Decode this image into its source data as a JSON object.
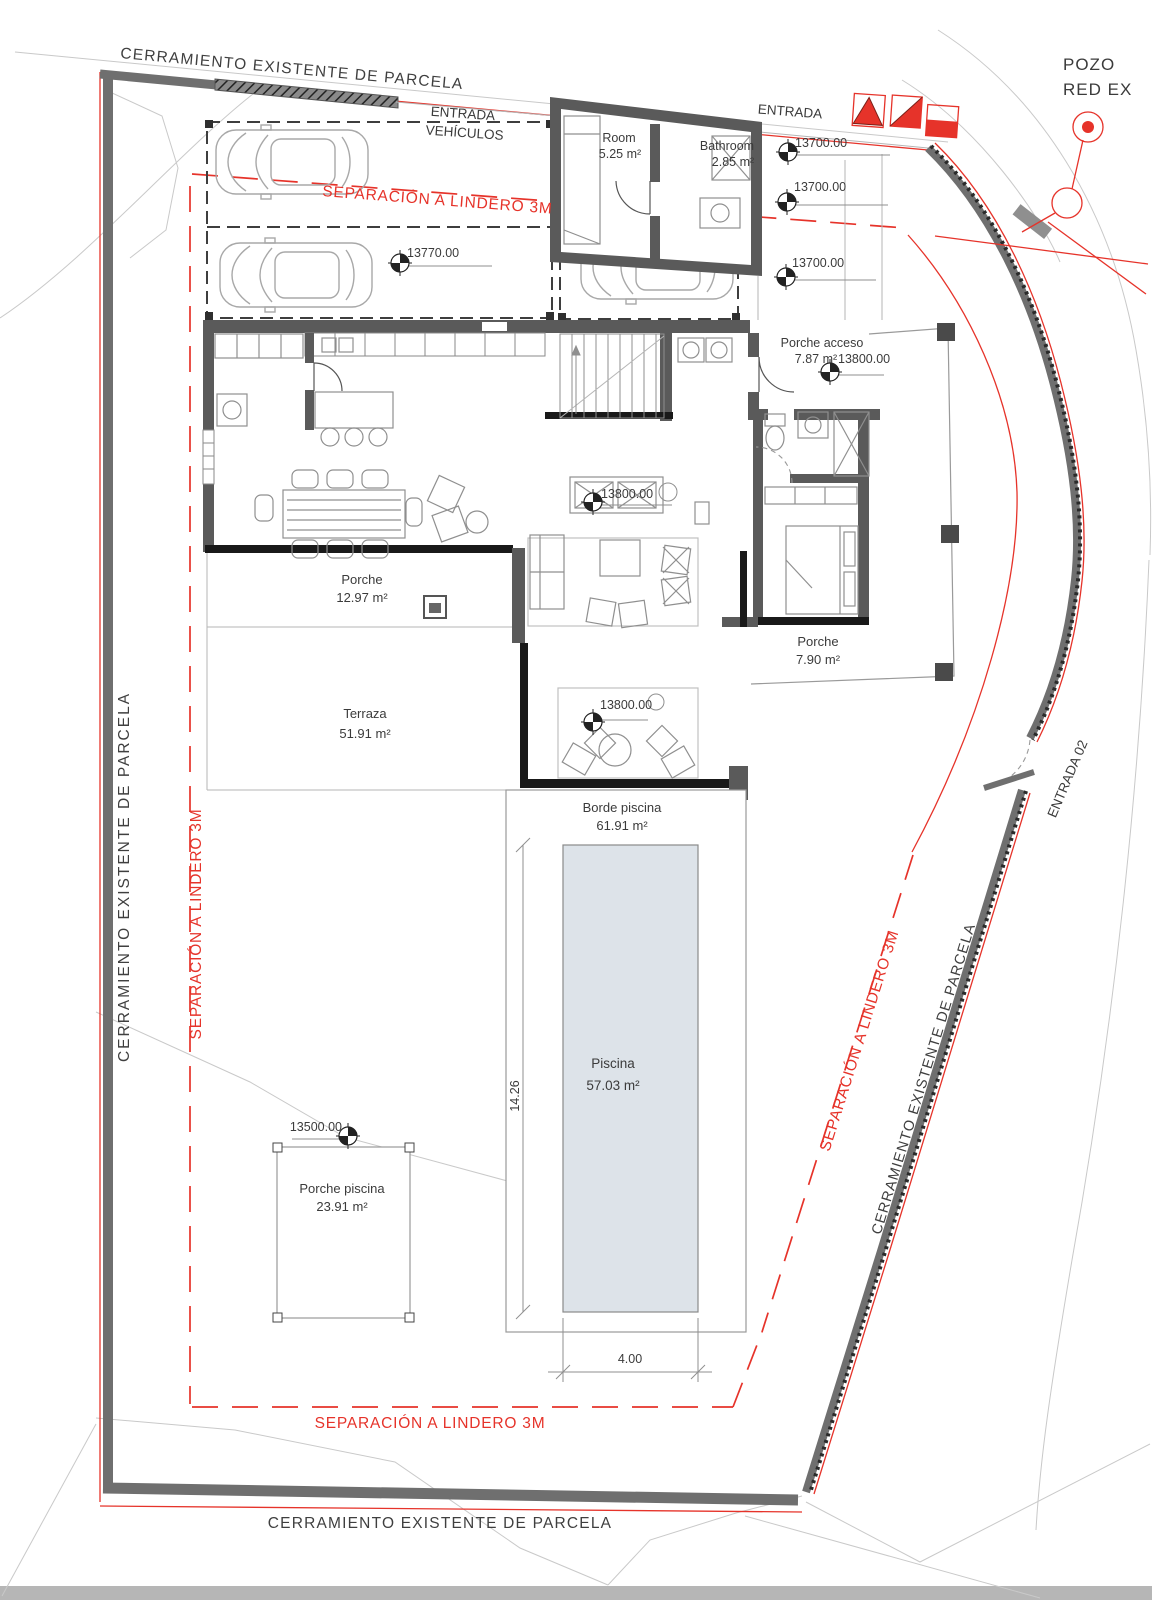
{
  "boundary": {
    "fence_label_top": "CERRAMIENTO EXISTENTE DE PARCELA",
    "fence_label_left": "CERRAMIENTO EXISTENTE DE PARCELA",
    "fence_label_right": "CERRAMIENTO EXISTENTE DE PARCELA",
    "fence_label_bottom": "CERRAMIENTO EXISTENTE DE PARCELA",
    "setback_label_top": "SEPARACIÓN A LINDERO 3M",
    "setback_label_left": "SEPARACIÓN A LINDERO 3M",
    "setback_label_right": "SEPARACIÓN A LINDERO 3M",
    "setback_label_bottom": "SEPARACIÓN A LINDERO 3M"
  },
  "entrances": {
    "vehicle_line1": "ENTRADA",
    "vehicle_line2": "VEHÍCULOS",
    "main": "ENTRADA",
    "secondary": "ENTRADA 02"
  },
  "utilities": {
    "pozo_line1": "POZO",
    "pozo_line2": "RED EX"
  },
  "rooms": [
    {
      "name": "Room",
      "area": "5.25 m²"
    },
    {
      "name": "Bathroom",
      "area": "2.85 m²"
    },
    {
      "name": "Porche acceso",
      "area": "7.87 m²"
    },
    {
      "name": "Porche",
      "area": "12.97 m²"
    },
    {
      "name": "Terraza",
      "area": "51.91 m²"
    },
    {
      "name": "Porche",
      "area": "7.90 m²"
    },
    {
      "name": "Borde piscina",
      "area": "61.91 m²"
    },
    {
      "name": "Piscina",
      "area": "57.03 m²"
    },
    {
      "name": "Porche piscina",
      "area": "23.91 m²"
    }
  ],
  "elevations": [
    {
      "value": "13700.00"
    },
    {
      "value": "13700.00"
    },
    {
      "value": "13700.00"
    },
    {
      "value": "13770.00"
    },
    {
      "value": "13800.00"
    },
    {
      "value": "13800.00"
    },
    {
      "value": "13800.00"
    },
    {
      "value": "13500.00"
    }
  ],
  "dimensions": {
    "pool_length": "14.26",
    "pool_width": "4.00"
  },
  "colors": {
    "red": "#e6332a",
    "wall_dark": "#5a5a5a",
    "glass_black": "#191919",
    "pool_fill": "#dde3e9",
    "contour": "#c9c9c9"
  }
}
